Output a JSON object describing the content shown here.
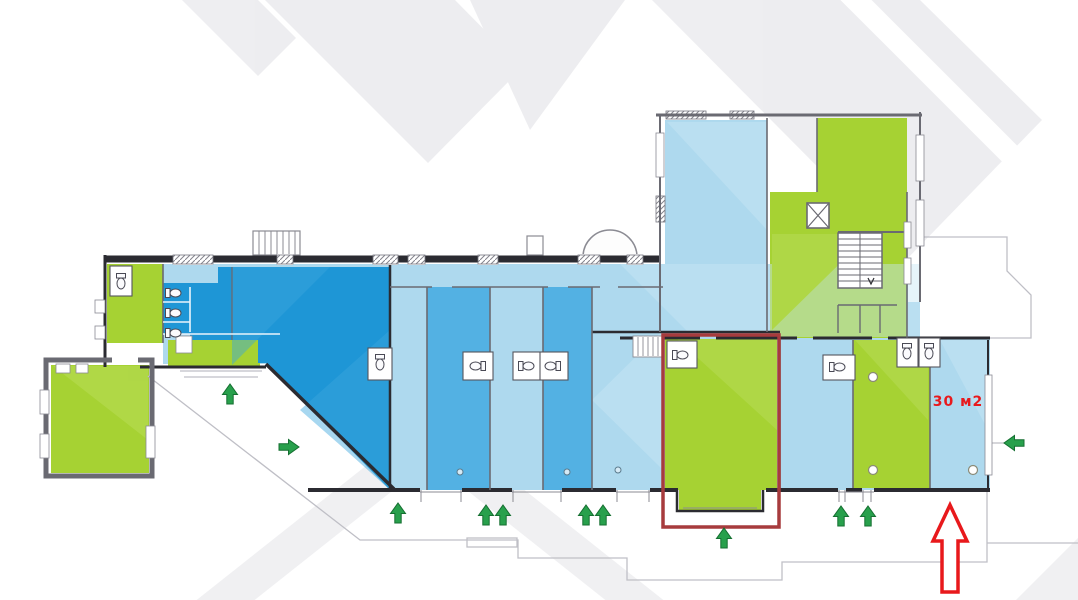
{
  "area_label": {
    "text": "30 м2"
  },
  "highlight": {
    "shape": "rectangle",
    "x": 663,
    "y": 335,
    "width": 116,
    "height": 192,
    "arrow": {
      "x": 950,
      "y": 549,
      "direction": "up"
    }
  },
  "entrance_arrows": [
    {
      "x": 230,
      "y": 394,
      "dir": "up"
    },
    {
      "x": 289,
      "y": 447,
      "dir": "right"
    },
    {
      "x": 398,
      "y": 513,
      "dir": "up"
    },
    {
      "x": 486,
      "y": 515,
      "dir": "up"
    },
    {
      "x": 503,
      "y": 515,
      "dir": "up"
    },
    {
      "x": 586,
      "y": 515,
      "dir": "up"
    },
    {
      "x": 603,
      "y": 515,
      "dir": "up"
    },
    {
      "x": 724,
      "y": 538,
      "dir": "up"
    },
    {
      "x": 841,
      "y": 516,
      "dir": "up"
    },
    {
      "x": 868,
      "y": 516,
      "dir": "up"
    },
    {
      "x": 1014,
      "y": 443,
      "dir": "left"
    }
  ],
  "palette": {
    "blue_dark": "#1e96d6",
    "blue_medium": "#53b1e3",
    "blue_pale": "#aed9ee",
    "blue_pale_light": "#c9e7f5",
    "blue_tint": "#3ba6de",
    "green": "#a6d233",
    "green_light": "#bcdf5e",
    "red_accent": "#e8191c",
    "red_outline": "#a73b3d",
    "arrow_green": "#28a04c",
    "arrow_green_dark": "#156f31",
    "wall_dark": "#2b2b31",
    "wall_mid": "#55555d",
    "wall_soft": "#6a6a72",
    "wall_light": "#8b8b93",
    "sidewalk": "#bfbfc6",
    "watermark": "#ebebee",
    "white": "#ffffff"
  }
}
